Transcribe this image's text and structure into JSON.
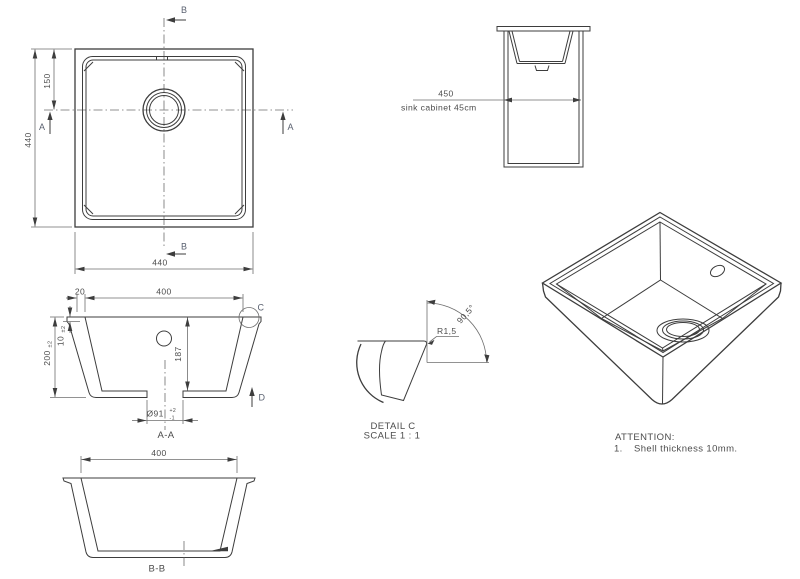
{
  "colors": {
    "line": "#3d3d3d",
    "dim_line": "#6e6e6e",
    "text": "#4c4c4c"
  },
  "plan": {
    "dim_height": "440",
    "dim_width": "440",
    "dim_drain_offset": "150",
    "section_marker_a": "A",
    "section_marker_b": "B"
  },
  "cabinet": {
    "dim_width": "450",
    "caption": "sink cabinet 45cm"
  },
  "section_aa": {
    "title": "A-A",
    "dim_opening": "400",
    "dim_rim_overhang": "20",
    "dim_height": "200",
    "dim_height_tolerance": "±2",
    "dim_wall_thickness": "10",
    "dim_wall_thickness_tolerance": "±2",
    "dim_inner_depth": "187",
    "dim_drain_diameter": "Ø91",
    "drain_tolerance_upper": "+2",
    "drain_tolerance_lower": "-1",
    "detail_marker": "C",
    "view_marker": "D"
  },
  "section_bb": {
    "title": "B-B",
    "dim_opening": "400"
  },
  "detail_c": {
    "title": "DETAIL C",
    "scale_note": "SCALE 1 : 1",
    "dim_corner_radius": "R1,5",
    "dim_wall_angle": "90,5°"
  },
  "attention": {
    "heading": "ATTENTION:",
    "note_number": "1.",
    "note_text": "Shell thickness 10mm."
  }
}
